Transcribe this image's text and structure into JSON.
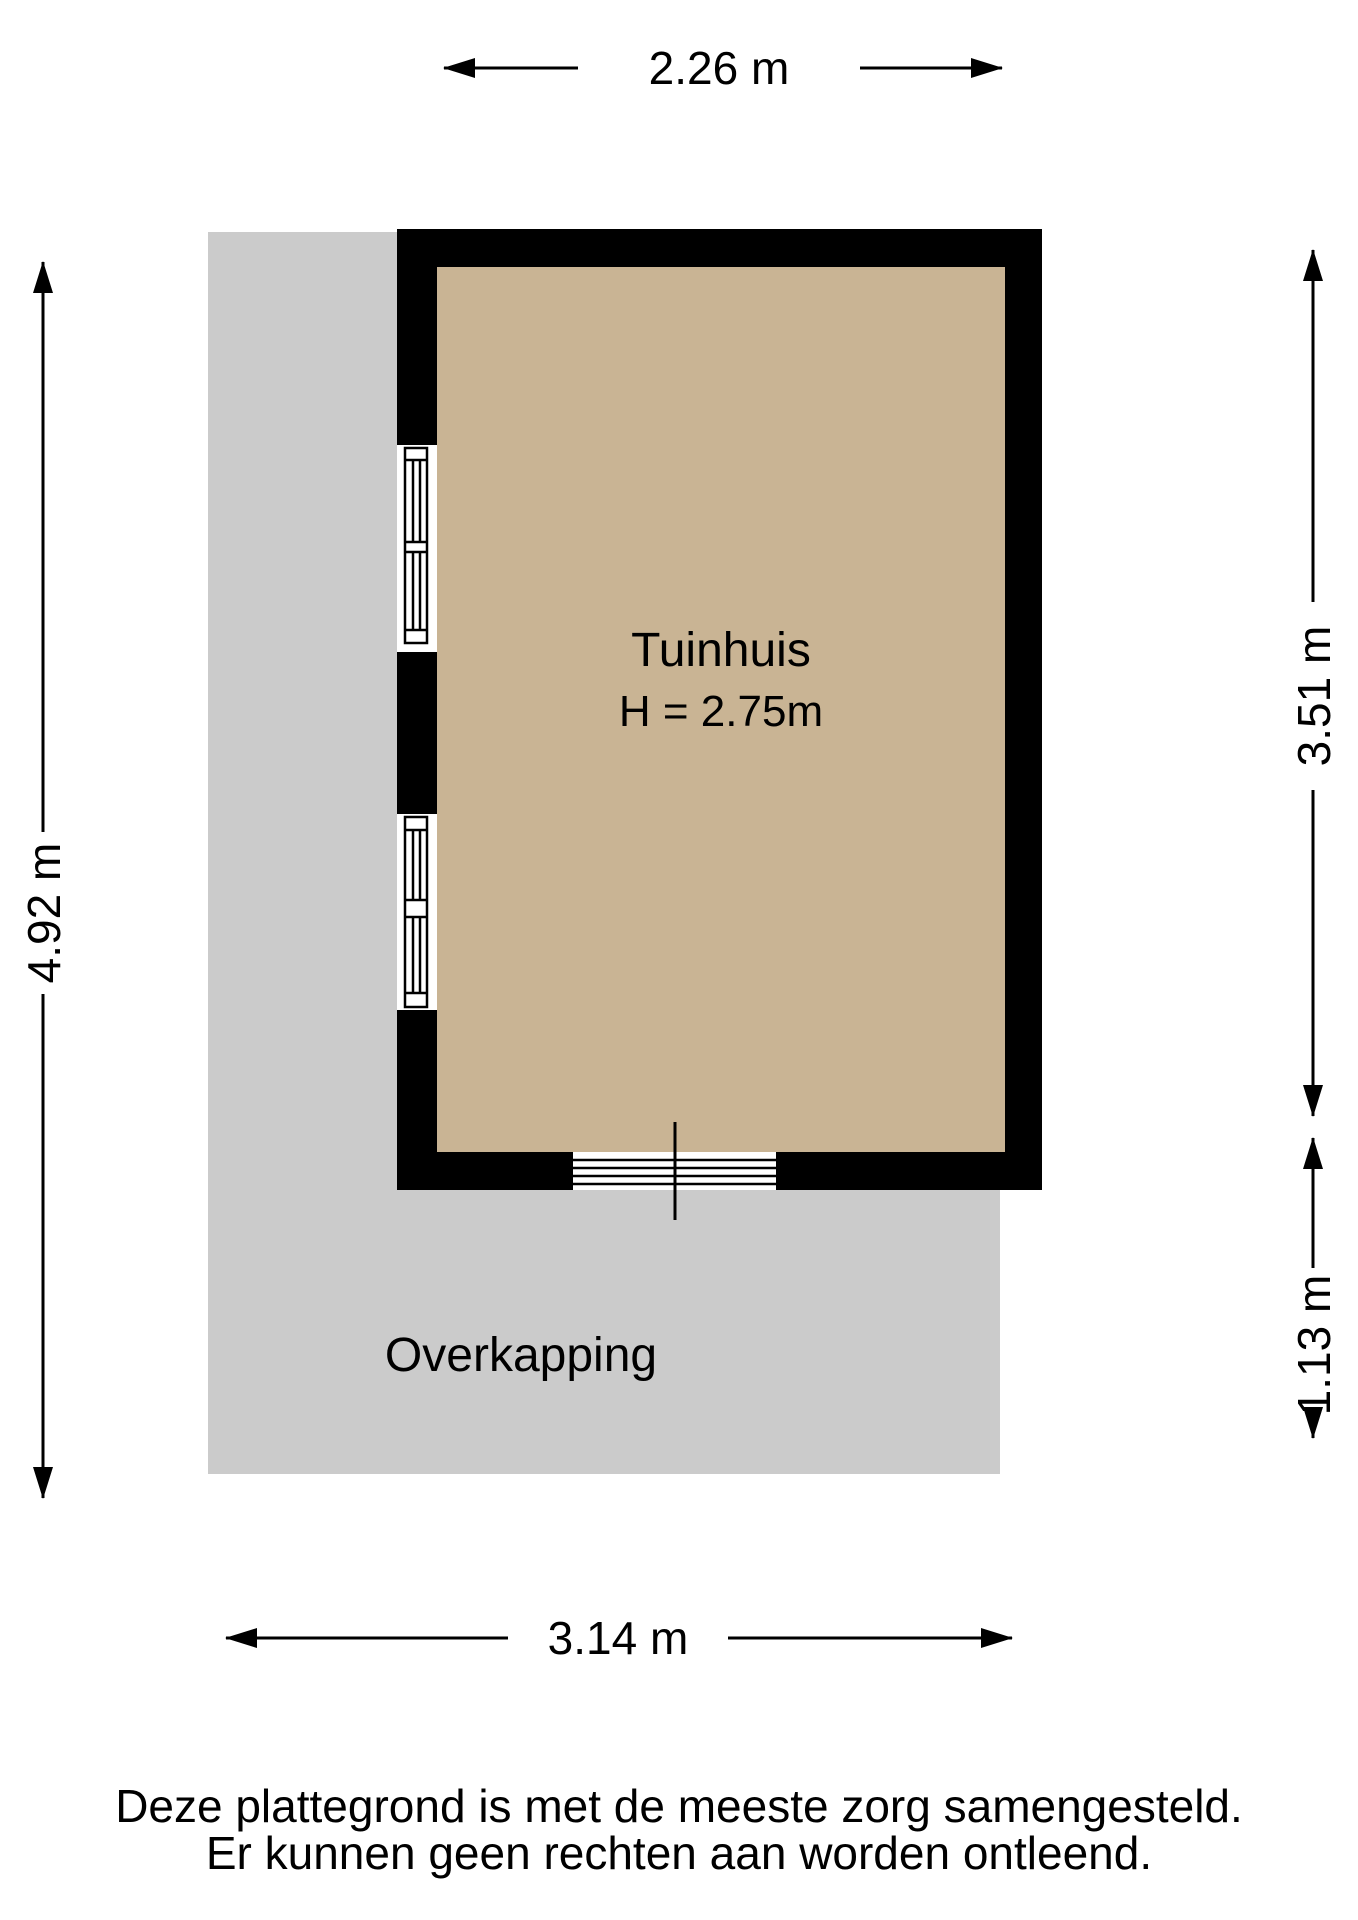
{
  "plan": {
    "room": {
      "name": "Tuinhuis",
      "height_label": "H = 2.75m"
    },
    "canopy": {
      "name": "Overkapping"
    },
    "dimensions": {
      "top": "2.26 m",
      "left": "4.92 m",
      "right_upper": "3.51 m",
      "right_lower": "1.13 m",
      "bottom": "3.14 m"
    },
    "colors": {
      "floor": "#c9b494",
      "canopy": "#cbcbcb",
      "wall": "#000000",
      "background": "#ffffff",
      "text": "#000000"
    }
  },
  "footer": {
    "line1": "Deze plattegrond is met de meeste zorg samengesteld.",
    "line2": "Er kunnen geen rechten aan worden ontleend."
  }
}
